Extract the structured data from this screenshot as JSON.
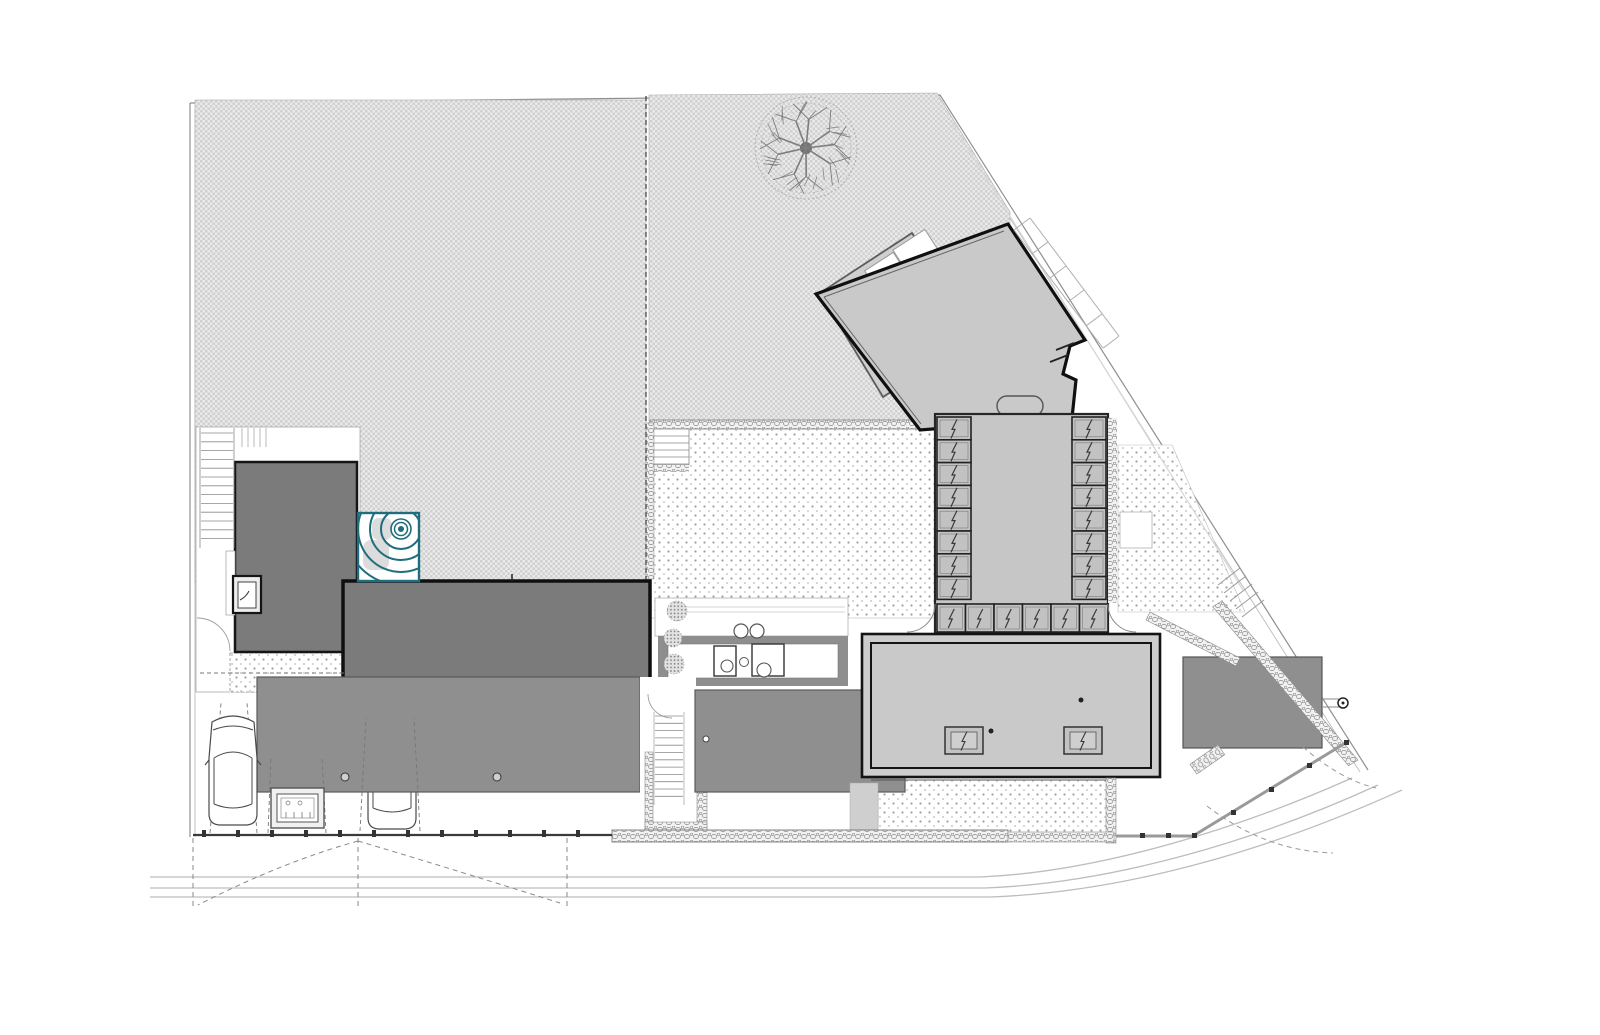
{
  "document": {
    "kind": "architectural site plan (roof plan), black/grey line drawing on white sheet",
    "visible_text": [],
    "sheet_width_px": 1600,
    "sheet_height_px": 1035
  },
  "palette": {
    "paper": "#ffffff",
    "ink": "#141414",
    "wall_line": "#555555",
    "light_line": "#9e9e9e",
    "boundary_line": "#8f8f8f",
    "street_line": "#bdbdbd",
    "lawn_light": "#eaeaea",
    "lawn_dark": "#d0d0d0",
    "terrace_dot": "#9f9f9f",
    "dark_roof": "#7b7b7b",
    "canopy_roof": "#8f8f8f",
    "light_roof": "#c9c9c9",
    "glass_panel": "#c2c2c2",
    "stone_fill": "#f1f1f1",
    "stone_line": "#8a8a8a",
    "spa_accent": "#1f6e7d",
    "spa_ring_fill": "#dcdcdc"
  },
  "features": {
    "site": {
      "boundary_style": "double parallel line, diagonal north-east edge",
      "lot_divider": "dashed vertical line between two garden lots",
      "south_street_lines": 3,
      "curved_southeast_street": true
    },
    "buildings": {
      "angled_pavilion": {
        "shape": "rotated pentagon with clipped corner",
        "bathtub_oval": 1,
        "rear_terrace": 1
      },
      "glazed_gallery": {
        "glass_panels_left": 8,
        "glass_panels_right": 8,
        "glass_panels_south": 6
      },
      "main_living_volume": {
        "border": "double heavy outline",
        "skylights": 2,
        "roof_dots": 2
      },
      "west_small_dark_roof": 1,
      "west_long_dark_roof": 1,
      "carport_canopy": {
        "roof_drains": 2
      },
      "central_walkway_canopy": {
        "roof_drains": 1
      },
      "east_canopy": {
        "post_circle": 1
      }
    },
    "landscape": {
      "trees": 1,
      "shrubs": 4,
      "lawn_lots": 2,
      "gravel_terraces": 4,
      "spa_with_concentric_rings": 1
    },
    "vehicles": {
      "cars_plan_view": 2
    },
    "site_furniture": {
      "outdoor_tables": 2,
      "stools": 5,
      "bbq_grill_unit": 1
    },
    "gates": {
      "south_gate_leaves_dashed": 2,
      "east_gate_leaves_dashed": 2
    }
  },
  "generator": {
    "glazing": {
      "left": {
        "x": 937,
        "y": 417,
        "w": 34,
        "h": 22.8,
        "count": 8
      },
      "right": {
        "x": 1072,
        "y": 417,
        "w": 34,
        "h": 22.8,
        "count": 8
      },
      "bottom": {
        "x": 937,
        "y": 604,
        "w": 28.5,
        "h": 28,
        "count": 6
      },
      "skylights": [
        [
          945,
          727
        ],
        [
          1064,
          727
        ]
      ]
    },
    "stairs": [
      {
        "x1": 201,
        "x2": 233,
        "y0": 433,
        "step": 8.8,
        "count": 13
      },
      {
        "x1": 653,
        "x2": 689,
        "y0": 436,
        "step": 7,
        "count": 5
      },
      {
        "x1": 655,
        "x2": 683,
        "y0": 716,
        "step": 7.3,
        "count": 12
      }
    ],
    "wall_ticks": {
      "x0": 242,
      "step": 6,
      "count": 5,
      "y1": 428,
      "y2": 447
    },
    "shrubs": [
      [
        677,
        611,
        10
      ],
      [
        673,
        638,
        9
      ],
      [
        674,
        664,
        10
      ],
      [
        679,
        688,
        9
      ]
    ],
    "tree": {
      "cx": 806,
      "cy": 148,
      "r": 52,
      "branches": 9,
      "twigs": 26
    },
    "fence_posts_front": {
      "x0": 202,
      "step": 34,
      "count": 12,
      "y": 830
    },
    "fence_posts_right": [
      [
        1140,
        833
      ],
      [
        1166,
        833
      ],
      [
        1192,
        833
      ],
      [
        1231,
        810
      ],
      [
        1269,
        787
      ],
      [
        1307,
        763
      ],
      [
        1344,
        740
      ]
    ],
    "parking_dashes": [
      [
        210,
        833,
        221,
        703
      ],
      [
        257,
        833,
        247,
        703
      ],
      [
        268,
        833,
        271,
        757
      ],
      [
        326,
        833,
        322,
        757
      ],
      [
        360,
        831,
        366,
        718
      ],
      [
        420,
        831,
        414,
        718
      ]
    ],
    "gate_dashes": [
      [
        193,
        838,
        193,
        906
      ],
      [
        358,
        838,
        358,
        908
      ],
      [
        567,
        838,
        567,
        906
      ]
    ],
    "terrace_steps": [
      [
        1218,
        585,
        1240,
        568
      ],
      [
        1224,
        593,
        1246,
        576
      ],
      [
        1230,
        601,
        1252,
        584
      ],
      [
        1236,
        609,
        1258,
        592
      ],
      [
        1242,
        617,
        1264,
        600
      ]
    ]
  }
}
